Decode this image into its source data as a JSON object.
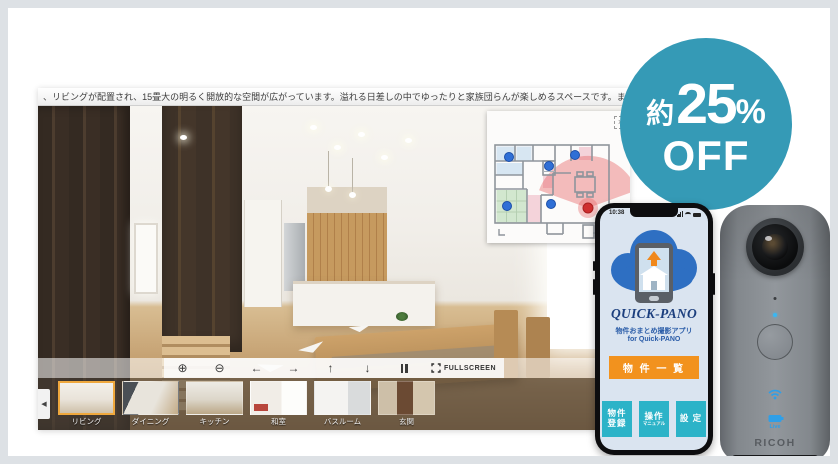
{
  "badge": {
    "prefix": "約",
    "number": "25",
    "percent": "%",
    "off": "OFF"
  },
  "viewer": {
    "marquee": "、リビングが配置され、15畳大の明るく開放的な空間が広がっています。溢れる日差しの中でゆったりと家族団らんが楽しめるスペースです。また、リビングと連続して和室",
    "toolbar": {
      "zoom_in": "⊕",
      "zoom_out": "⊖",
      "left": "←",
      "right": "→",
      "up": "↑",
      "down": "↓",
      "fullscreen": "FULLSCREEN",
      "prev": "◀"
    },
    "floorplan_close": "×",
    "thumbnails": [
      {
        "label": "リビング",
        "selected": true
      },
      {
        "label": "ダイニング",
        "selected": false
      },
      {
        "label": "キッチン",
        "selected": false
      },
      {
        "label": "和室",
        "selected": false
      },
      {
        "label": "バスルーム",
        "selected": false
      },
      {
        "label": "玄関",
        "selected": false
      }
    ],
    "selected_thumbnail": "リビング"
  },
  "phone": {
    "time": "10:38",
    "logo": "QUICK-PANO",
    "app_subtitle_1": "物件おまとめ撮影アプリ",
    "app_subtitle_2": "for Quick-PANO",
    "list_button": "物 件 一 覧",
    "register_button_line1": "物件",
    "register_button_line2": "登録",
    "manual_button_line1": "操作",
    "manual_button_line2": "マニュアル",
    "settings_button": "設 定"
  },
  "camera": {
    "brand": "RICOH",
    "live": "Live"
  },
  "colors": {
    "badge_teal": "#359AB6",
    "app_orange": "#F2921E",
    "app_teal": "#2CB3C8",
    "logo_navy": "#1C3F7E",
    "cloud_blue": "#2E6FC2",
    "selected_thumb_border": "#EFA83D",
    "marker_blue": "#2F6FD6",
    "marker_red": "#CF2F2F"
  }
}
